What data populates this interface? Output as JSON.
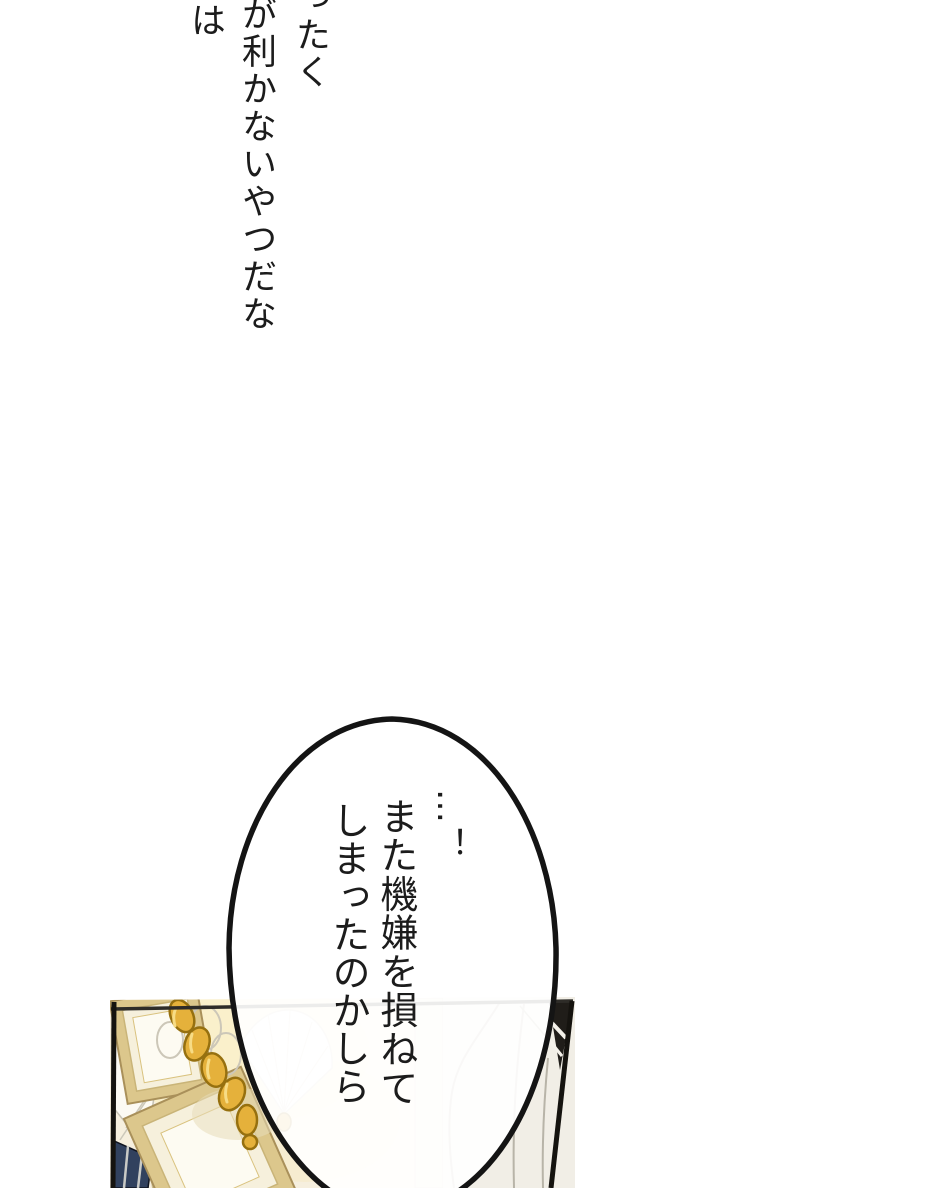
{
  "monologue": {
    "columns": [
      "ったく",
      "が利かないやつだな",
      "は"
    ]
  },
  "speech_bubble": {
    "columns": [
      "…！",
      "また機嫌を損ねて",
      "しまったのかしら"
    ]
  },
  "colors": {
    "page_background": "#FFFFFF",
    "ink": "#1C1C1C",
    "panel_border": "#15130F",
    "wall_cream": "#F6EFDE",
    "glow_yellow": "#FAF0C8",
    "chain_gold": "#E5B13B",
    "chain_gold_highlight": "#F7DC85",
    "frame_gold": "#DCC78C",
    "frame_mat_cream": "#F6F0DC",
    "curtain_white": "#F1EEE6",
    "shutter_navy": "#31415E"
  }
}
